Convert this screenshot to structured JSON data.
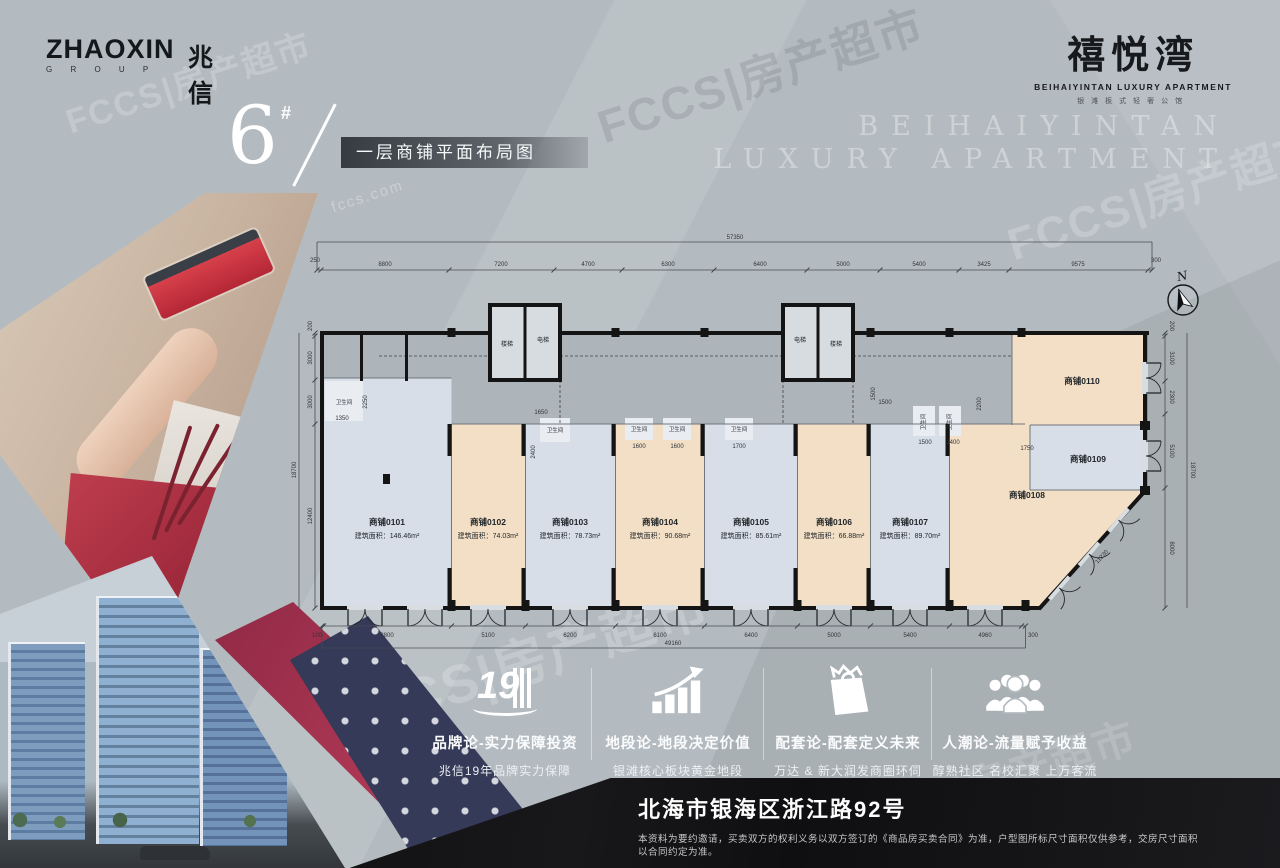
{
  "brand": {
    "name_en": "ZHAOXIN",
    "group": "G R O U P",
    "name_cn": "兆信"
  },
  "project": {
    "name_cn": "禧悦湾",
    "name_en": "BEIHAIYINTAN LUXURY APARTMENT",
    "tagline": "银滩板式轻奢公馆"
  },
  "bg_watermark": {
    "line1": "BEIHAIYINTAN",
    "line2": "LUXURY APARTMENT"
  },
  "header": {
    "block_no": "6",
    "superscript": "#",
    "title": "一层商铺平面布局图"
  },
  "plan": {
    "compass_label": "N",
    "totals": {
      "top": "57350",
      "bottom": "49160",
      "left": "18700",
      "right": "18700",
      "diagonal": "11230"
    },
    "dims_top": [
      "250",
      "8800",
      "7200",
      "4700",
      "6300",
      "6400",
      "5000",
      "5400",
      "3425",
      "9575",
      "300"
    ],
    "dims_bottom": [
      "100",
      "8800",
      "5100",
      "6200",
      "6100",
      "6400",
      "5000",
      "5400",
      "4960",
      "300"
    ],
    "dims_left": [
      "200",
      "3000",
      "3000",
      "12400"
    ],
    "dims_right": [
      "200",
      "3100",
      "2300",
      "5100",
      "8000"
    ],
    "interior_dims": [
      "1350",
      "2250",
      "1650",
      "2400",
      "1600",
      "1600",
      "1700",
      "1500",
      "1500",
      "1500",
      "1400",
      "2200",
      "1750"
    ],
    "wc_label": "卫生间",
    "core1": {
      "left": "楼梯",
      "right": "电梯"
    },
    "core2": {
      "left": "电梯",
      "right": "楼梯"
    },
    "shops": [
      {
        "name": "商铺0101",
        "area": "建筑面积：146.46m²"
      },
      {
        "name": "商铺0102",
        "area": "建筑面积：74.03m²"
      },
      {
        "name": "商铺0103",
        "area": "建筑面积：78.73m²"
      },
      {
        "name": "商铺0104",
        "area": "建筑面积：90.68m²"
      },
      {
        "name": "商铺0105",
        "area": "建筑面积：85.61m²"
      },
      {
        "name": "商铺0106",
        "area": "建筑面积：66.88m²"
      },
      {
        "name": "商铺0107",
        "area": "建筑面积：89.70m²"
      },
      {
        "name": "商铺0108",
        "area": ""
      },
      {
        "name": "商铺0109",
        "area": ""
      },
      {
        "name": "商铺0110",
        "area": ""
      }
    ]
  },
  "features": [
    {
      "icon": "building-19-icon",
      "badge": "19",
      "title": "品牌论-实力保障投资",
      "subtitle": "兆信19年品牌实力保障"
    },
    {
      "icon": "growth-chart-icon",
      "title": "地段论-地段决定价值",
      "subtitle": "银滩核心板块黄金地段"
    },
    {
      "icon": "shopping-bag-icon",
      "title": "配套论-配套定义未来",
      "subtitle": "万达 & 新大润发商圈环伺"
    },
    {
      "icon": "crowd-icon",
      "title": "人潮论-流量赋予收益",
      "subtitle": "醇熟社区 名校汇聚 上万客流"
    }
  ],
  "footer": {
    "address": "北海市银海区浙江路92号",
    "disclaimer": "本资料为要约邀请，买卖双方的权利义务以双方签订的《商品房买卖合同》为准，户型图所标尺寸面积仅供参考，交房尺寸面积以合同约定为准。"
  },
  "watermark": {
    "brand": "FCCS|房产超市",
    "site": "fccs.com"
  }
}
